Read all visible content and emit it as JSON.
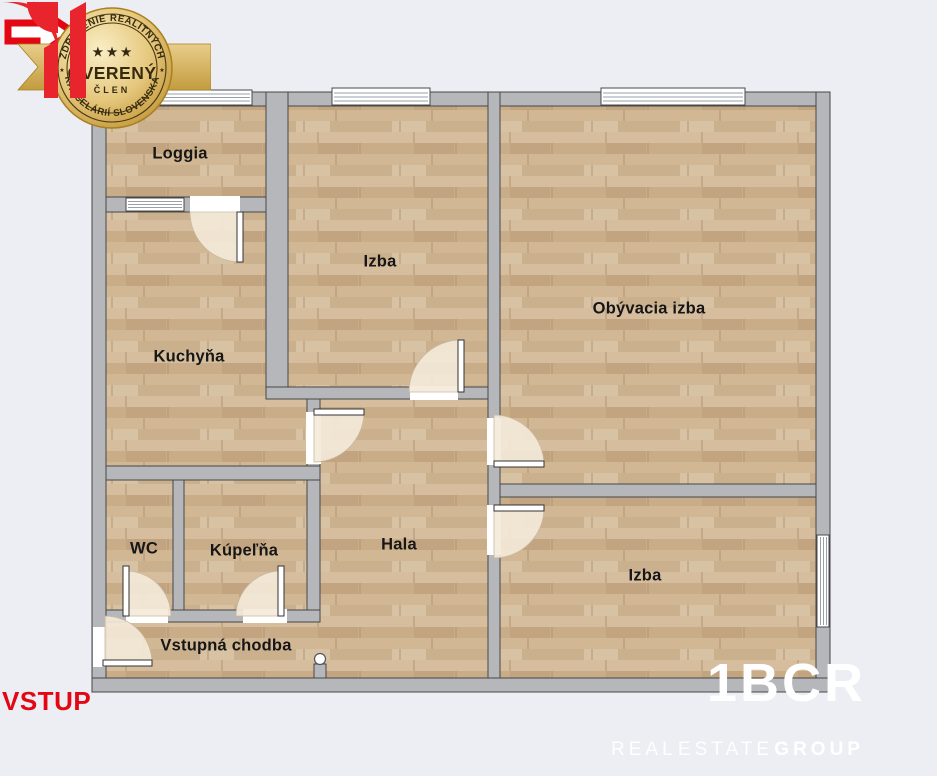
{
  "floorplan": {
    "rooms": [
      {
        "id": "loggia",
        "label": "Loggia"
      },
      {
        "id": "izba-top",
        "label": "Izba"
      },
      {
        "id": "obyvacia-izba",
        "label": "Obývacia izba"
      },
      {
        "id": "kuchyna",
        "label": "Kuchyňa"
      },
      {
        "id": "wc",
        "label": "WC"
      },
      {
        "id": "kupelna",
        "label": "Kúpeľňa"
      },
      {
        "id": "hala",
        "label": "Hala"
      },
      {
        "id": "izba-bottom",
        "label": "Izba"
      },
      {
        "id": "vstupna-chodba",
        "label": "Vstupná chodba"
      }
    ]
  },
  "entrance": {
    "label": "VSTUP"
  },
  "badge": {
    "top_arc": "ZDRUŽENIE REALITNÝCH",
    "bottom_arc": "KANCELÁRIÍ SLOVENSKA",
    "title": "OVERENÝ",
    "member": "ČLEN",
    "stars": "★ ★ ★",
    "side_star": "★"
  },
  "logo": {
    "name": "1BCR",
    "words": [
      "REAL",
      "ESTATE",
      "GROUP"
    ]
  },
  "colors": {
    "background": "#eceef4",
    "wall_fill": "#b5b7bb",
    "wall_outline": "#474747",
    "wood_base": "#cfb593",
    "door_fan": "#f4ead9",
    "accent_red": "#e30613",
    "logo_red": "#e8252d",
    "badge_gold": "#d9b55e",
    "label_text": "#161616",
    "logo_text": "#ffffff"
  }
}
